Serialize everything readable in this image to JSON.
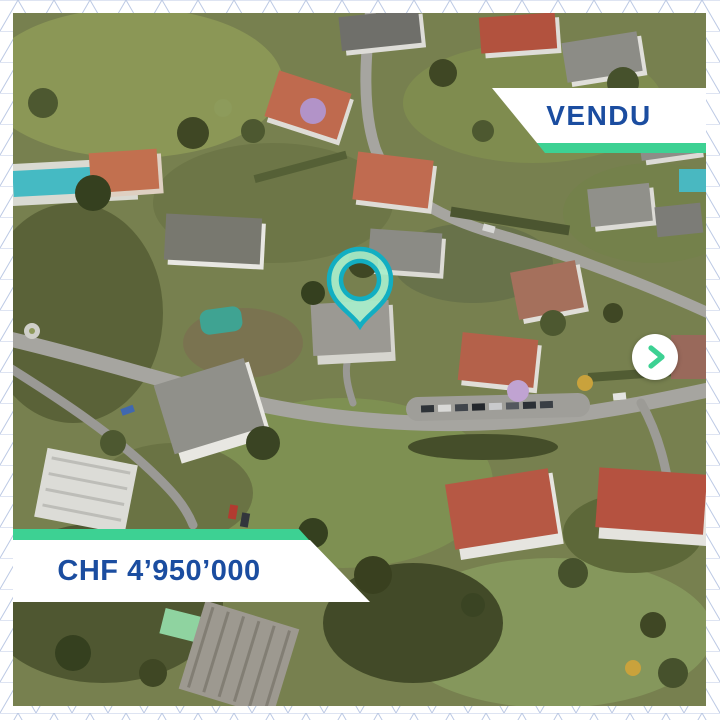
{
  "card": {
    "status_banner": {
      "label": "VENDU"
    },
    "price_banner": {
      "label": "CHF 4’950’000"
    },
    "carousel": {
      "next_icon": "chevron-right-icon"
    },
    "map_pin_icon": "location-pin-icon"
  },
  "colors": {
    "accent_green": "#3dd193",
    "banner_text_blue": "#1b4da0",
    "banner_bg": "#ffffff",
    "pin_stroke": "#12aec2",
    "pin_fill": "#a9eecb",
    "border_pattern_line": "#bcc9e4"
  }
}
